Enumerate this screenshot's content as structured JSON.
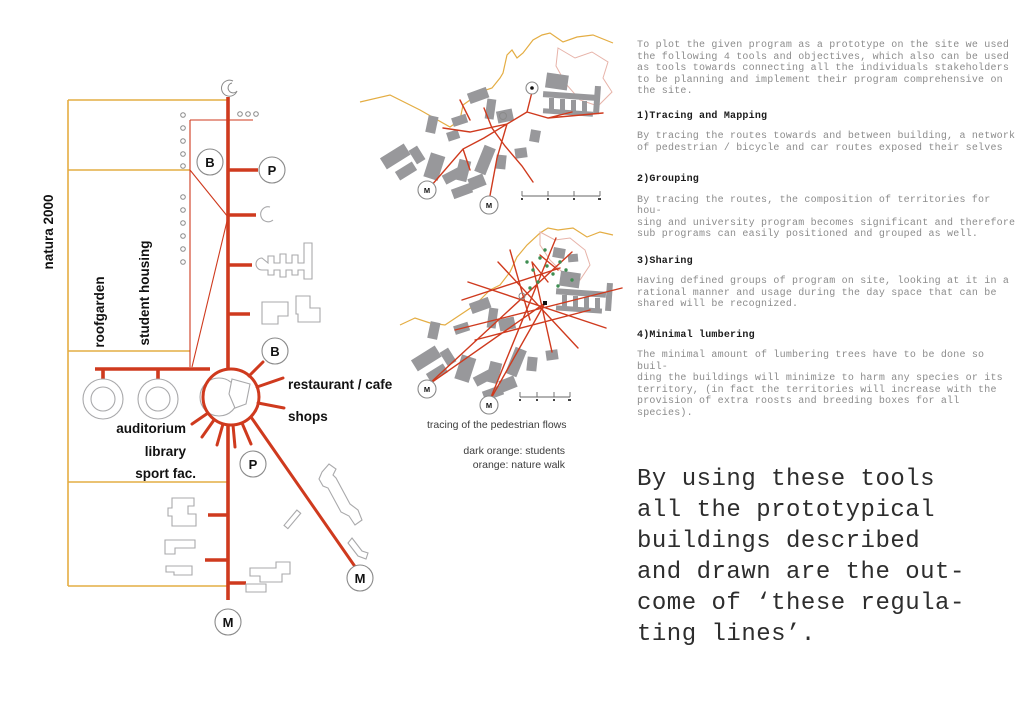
{
  "colors": {
    "red": "#cf3a1e",
    "yellow": "#e4ad43",
    "map_gray": "#98989b",
    "outline_gray": "#a9a9ab",
    "ring_gray": "#8a8a8a",
    "green": "#3e8e52",
    "pink": "#e7b3a9",
    "body_text": "#8c8c8c",
    "heading_text": "#1b1b1b",
    "closing_text": "#2d2d2d",
    "caption_text": "#3c3c3c",
    "label_text": "#111111"
  },
  "diagram": {
    "area_label": "natura 2000",
    "band_labels": [
      "roofgarden",
      "student housing"
    ],
    "hub_labels": [
      "auditorium",
      "library",
      "sport fac."
    ],
    "right_labels": [
      "restaurant / cafe",
      "shops"
    ],
    "markers": {
      "bus": "B",
      "parking": "P",
      "metro": "M"
    }
  },
  "maps": {
    "caption": "tracing of the pedestrian flows",
    "legend_line1": "dark orange: students",
    "legend_line2": "orange: nature walk"
  },
  "text_column": {
    "intro": "To plot the given program as a prototype on the site we used\nthe following 4 tools and objectives, which also can be used\nas tools towards connecting all the individuals stakeholders\nto be planning and implement their program comprehensive on\nthe site.",
    "sections": [
      {
        "heading": "1)Tracing and Mapping",
        "body": "By tracing the routes towards and between building, a network\nof pedestrian / bicycle and car routes exposed their selves"
      },
      {
        "heading": "2)Grouping",
        "body": "By tracing the routes, the composition of territories for hou-\nsing and university program becomes significant and therefore\nsub programs can easily positioned and grouped as well."
      },
      {
        "heading": "3)Sharing",
        "body": "Having defined groups of program on site, looking at it in a\nrational manner and usage during the day space that can be\nshared will be recognized."
      },
      {
        "heading": "4)Minimal lumbering",
        "body": "The minimal amount of lumbering trees have to be done so buil-\nding the buildings will minimize to harm any species or its\nterritory, (in fact the territories will increase with the\nprovision of extra roosts and breeding boxes for all species)."
      }
    ],
    "closing": "By using these tools\nall the prototypical\nbuildings described\nand drawn are the out-\ncome of ‘these regula-\nting lines’."
  }
}
